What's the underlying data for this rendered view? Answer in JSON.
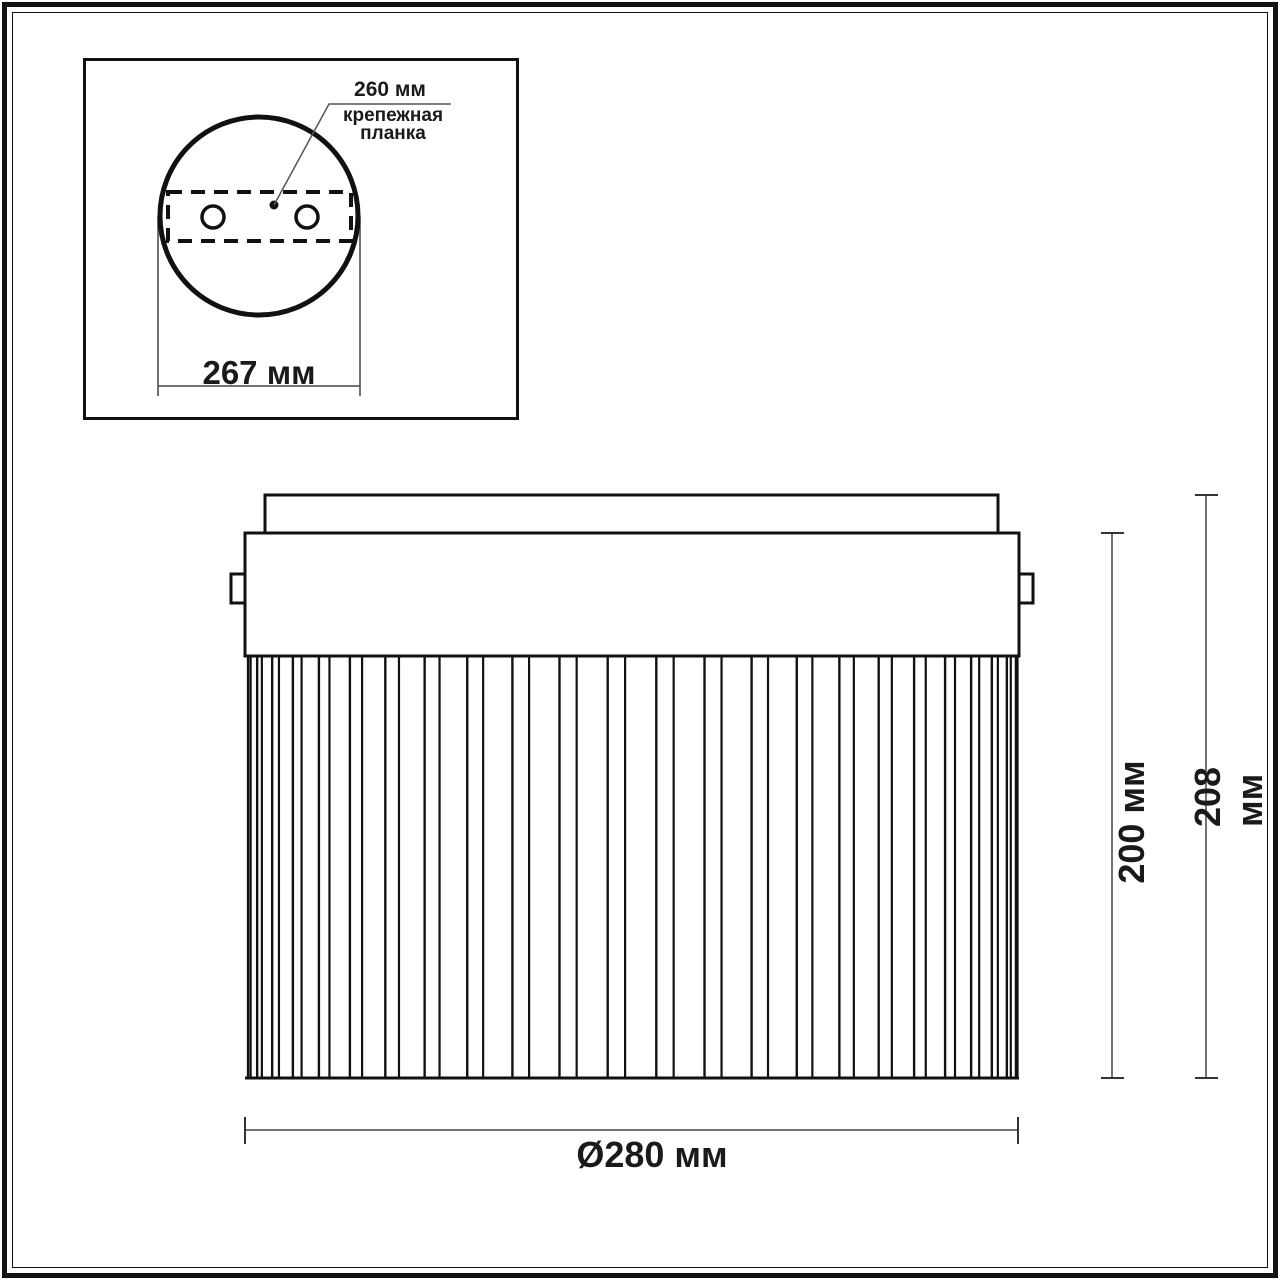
{
  "inset": {
    "dim_plate_length": "260 мм",
    "plate_label": "крепежная\nпланка",
    "dim_plate_width": "267 мм"
  },
  "front_view": {
    "dim_diameter": "Ø280 мм",
    "dim_height_body": "200 мм",
    "dim_height_total": "208 мм"
  },
  "colors": {
    "line": "#1a1a1a",
    "dim_line": "#444444",
    "background": "#ffffff"
  }
}
